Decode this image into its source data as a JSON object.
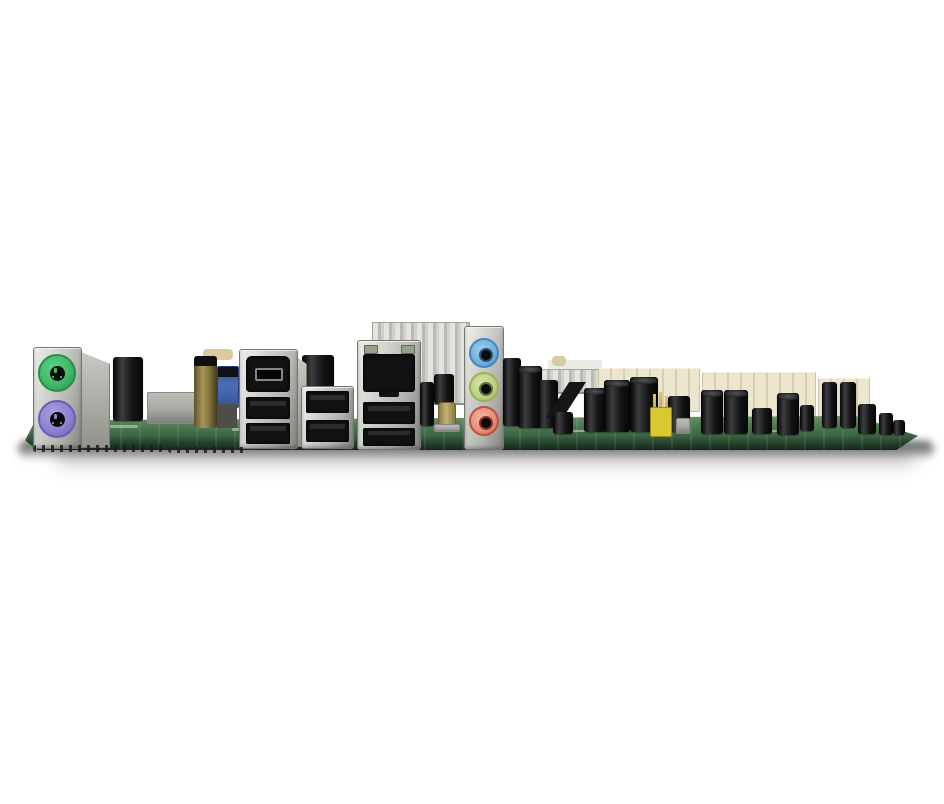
{
  "meta": {
    "type": "photograph",
    "description": "Side-profile photograph of a desktop motherboard lying flat on a white background, showing the rear I/O panel connectors edge-on: stacked PS/2 ports, FireWire and USB ports, Gigabit Ethernet above two USB ports, a finned chipset heatsink, three analog audio jacks, and rows of capacitors, jumpers and expansion-slot edges along the board.",
    "background_color": "#ffffff",
    "visible_text": ""
  },
  "palette": {
    "background": "#ffffff",
    "pcb_green": "#4d7a52",
    "pcb_edge_dark": "#24402b",
    "silkscreen": "#a9c2a4",
    "metal_light": "#dcdcd8",
    "metal_mid": "#b2b2ae",
    "metal_dark": "#83837f",
    "port_black": "#121212",
    "cap_sheen": "#3e3e42",
    "ps2_green": "#3fb966",
    "ps2_green_dark": "#2c8d4b",
    "ps2_purple": "#8d82cf",
    "ps2_purple_dark": "#6a5eb5",
    "audio_blue": "#6fb0dc",
    "audio_blue_dark": "#4687c2",
    "audio_lime": "#bdd07f",
    "audio_lime_dark": "#97b257",
    "audio_pink": "#e29079",
    "audio_pink_dark": "#c0503c",
    "heatsink_light": "#e3e3df",
    "heatsink_dark": "#b9b9b5",
    "slot_cream": "#ece6cf",
    "slot_cream_line": "#d5ceb1",
    "gold_cap": "#a89658",
    "gold_cap_dark": "#5e5230",
    "jumper_yellow": "#d9c832",
    "pin_gold": "#c6a63e",
    "usb_header_blue": "#4a6fb5",
    "led_window": "#97a28c",
    "crystal_gold": "#c4b274",
    "gray_shield": "#a9a9a4",
    "tan_component": "#d6c59a"
  },
  "components": {
    "photo": "Motherboard rear I/O side-view photograph",
    "pcb": "Motherboard PCB edge (green)",
    "shadow": "Soft shadow cast under the board",
    "ps2_stack": "Stacked PS/2 connector block (metal shield)",
    "ps2_mouse": "PS/2 mouse port (green)",
    "ps2_keyboard": "PS/2 keyboard port (purple)",
    "capacitor": "Black electrolytic capacitor",
    "gold_capacitor": "Gold/olive electrolytic capacitor",
    "usb_header": "Blue internal header connector",
    "shield": "Low metal shield / bracket",
    "firewire_stack": "FireWire + dual USB metal stack",
    "firewire": "IEEE-1394 FireWire port",
    "usb": "USB 2.0 Type-A port",
    "usb_stack": "Dual stacked USB 2.0 ports",
    "ethernet_stack": "Ethernet + dual USB metal stack",
    "ethernet": "Gigabit Ethernet RJ45 port",
    "ethernet_led": "RJ45 link/activity LED window",
    "heatsink": "Aluminum finned chipset heatsink",
    "small_heatsink": "Small finned VRM heatsink",
    "audio_stack": "Analog audio jack block",
    "line_in": "Line-in audio jack (blue)",
    "line_out": "Line-out audio jack (lime)",
    "mic_in": "Microphone jack (pink)",
    "crystal": "Gold clock-crystal component",
    "expansion_slot": "Expansion slot edge (cream, seen end-on)",
    "jumper": "Yellow jumper block on gold header pins",
    "header": "Black pin-header connector",
    "solder": "Solder joints along board underside",
    "silkscreen": "White silkscreen printing on PCB"
  }
}
